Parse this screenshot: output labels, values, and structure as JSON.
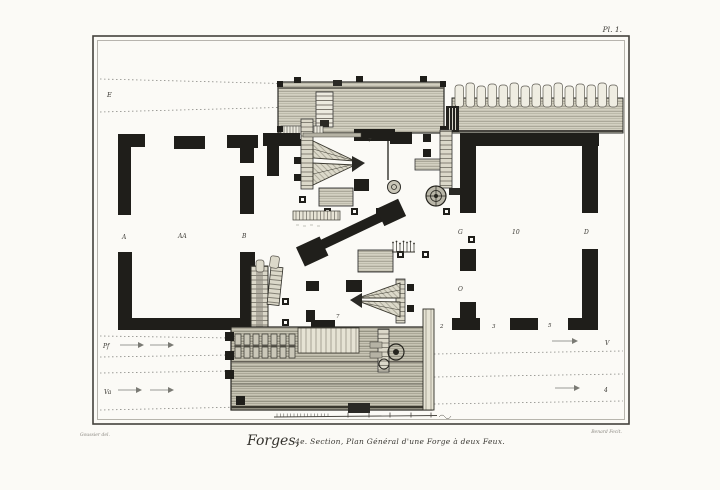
{
  "plate": {
    "number": "Pl. 1.",
    "title_script": "Forges,",
    "title_rest": "4e. Section, Plan Général d'une Forge à deux Feux.",
    "credit_left": "Goussier del.",
    "credit_right": "Benard Fecit."
  },
  "plan_labels": [
    {
      "id": "E",
      "text": "E"
    },
    {
      "id": "A",
      "text": "A"
    },
    {
      "id": "AA",
      "text": "AA"
    },
    {
      "id": "B",
      "text": "B"
    },
    {
      "id": "G",
      "text": "G"
    },
    {
      "id": "ten",
      "text": "10"
    },
    {
      "id": "D",
      "text": "D"
    },
    {
      "id": "O",
      "text": "O"
    },
    {
      "id": "two",
      "text": "2"
    },
    {
      "id": "three",
      "text": "3"
    },
    {
      "id": "five",
      "text": "5"
    },
    {
      "id": "seven-top",
      "text": "7"
    },
    {
      "id": "seven-bottom",
      "text": "7"
    },
    {
      "id": "Pf",
      "text": "Pf"
    },
    {
      "id": "Va",
      "text": "Va"
    },
    {
      "id": "V",
      "text": "V"
    },
    {
      "id": "four",
      "text": "4"
    }
  ],
  "colors": {
    "paper": "#fbfaf6",
    "ink": "#1f1e1a",
    "hatch_line": "#8a8778"
  }
}
